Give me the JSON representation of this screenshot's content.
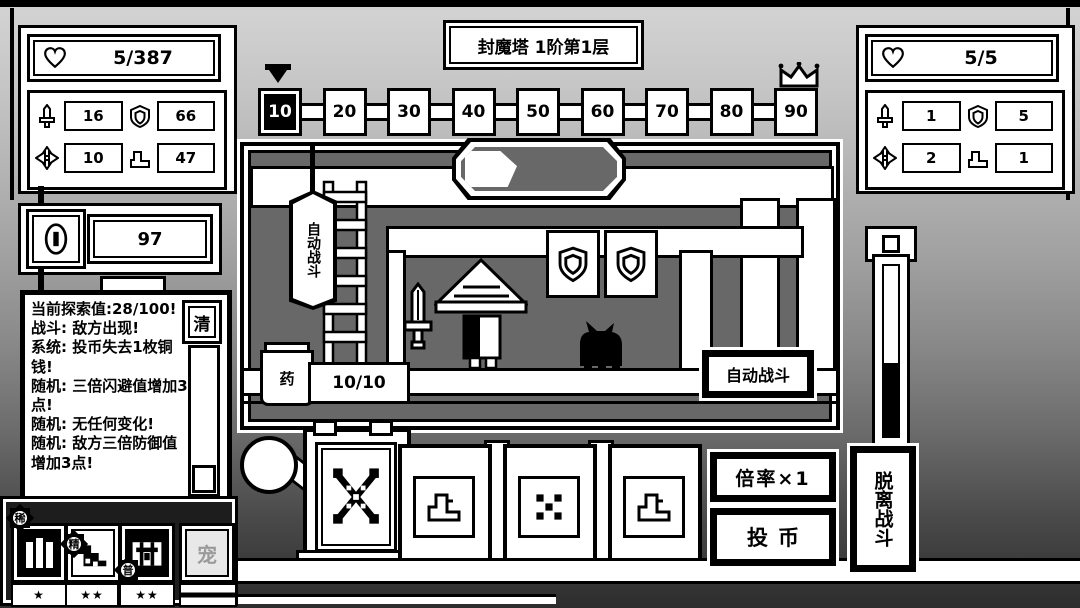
{
  "header": {
    "title": "封魔塔 1阶第1层"
  },
  "player_panel": {
    "hp": "5/387",
    "atk": "16",
    "def": "66",
    "dodge": "10",
    "speed": "47"
  },
  "enemy_panel": {
    "hp": "5/5",
    "atk": "1",
    "def": "5",
    "dodge": "2",
    "speed": "1"
  },
  "coin_panel": {
    "coins": "97"
  },
  "battle_log": {
    "clear_label": "清",
    "lines": [
      "当前探索值:28/100!",
      "战斗: 敌方出现!",
      "系统: 投币失去1枚铜钱!",
      "随机: 三倍闪避值增加3点!",
      "随机: 无任何变化!",
      "随机: 敌方三倍防御值增加3点!"
    ]
  },
  "floor_track": {
    "nodes": [
      "10",
      "20",
      "30",
      "40",
      "50",
      "60",
      "70",
      "80",
      "90"
    ],
    "current": "10"
  },
  "scene": {
    "auto_battle_sign": "自动战斗",
    "potion_jar_label": "药",
    "potion_count": "10/10",
    "auto_battle_button": "自动战斗"
  },
  "action_buttons": {
    "multiplier": "倍率×1",
    "insert_coin": "投币",
    "leave_battle": "脱离战斗"
  },
  "inventory": {
    "slots": [
      {
        "rarity_badge": "稀",
        "stars": "★"
      },
      {
        "rarity_badge": "精",
        "stars": "★★"
      },
      {
        "rarity_badge": "普",
        "stars": "★★"
      },
      {
        "label": "宠",
        "stars": ""
      }
    ]
  },
  "icons": {
    "hp": "heart-icon",
    "attack": "sword-icon",
    "defense": "shield-icon",
    "dodge": "cross-star-icon",
    "speed": "boot-icon",
    "currency": "coin-icon",
    "goal": "crown-icon",
    "position": "marker-icon"
  },
  "colors": {
    "ink": "#000000",
    "paper": "#ffffff",
    "scene_background": "#686868"
  }
}
